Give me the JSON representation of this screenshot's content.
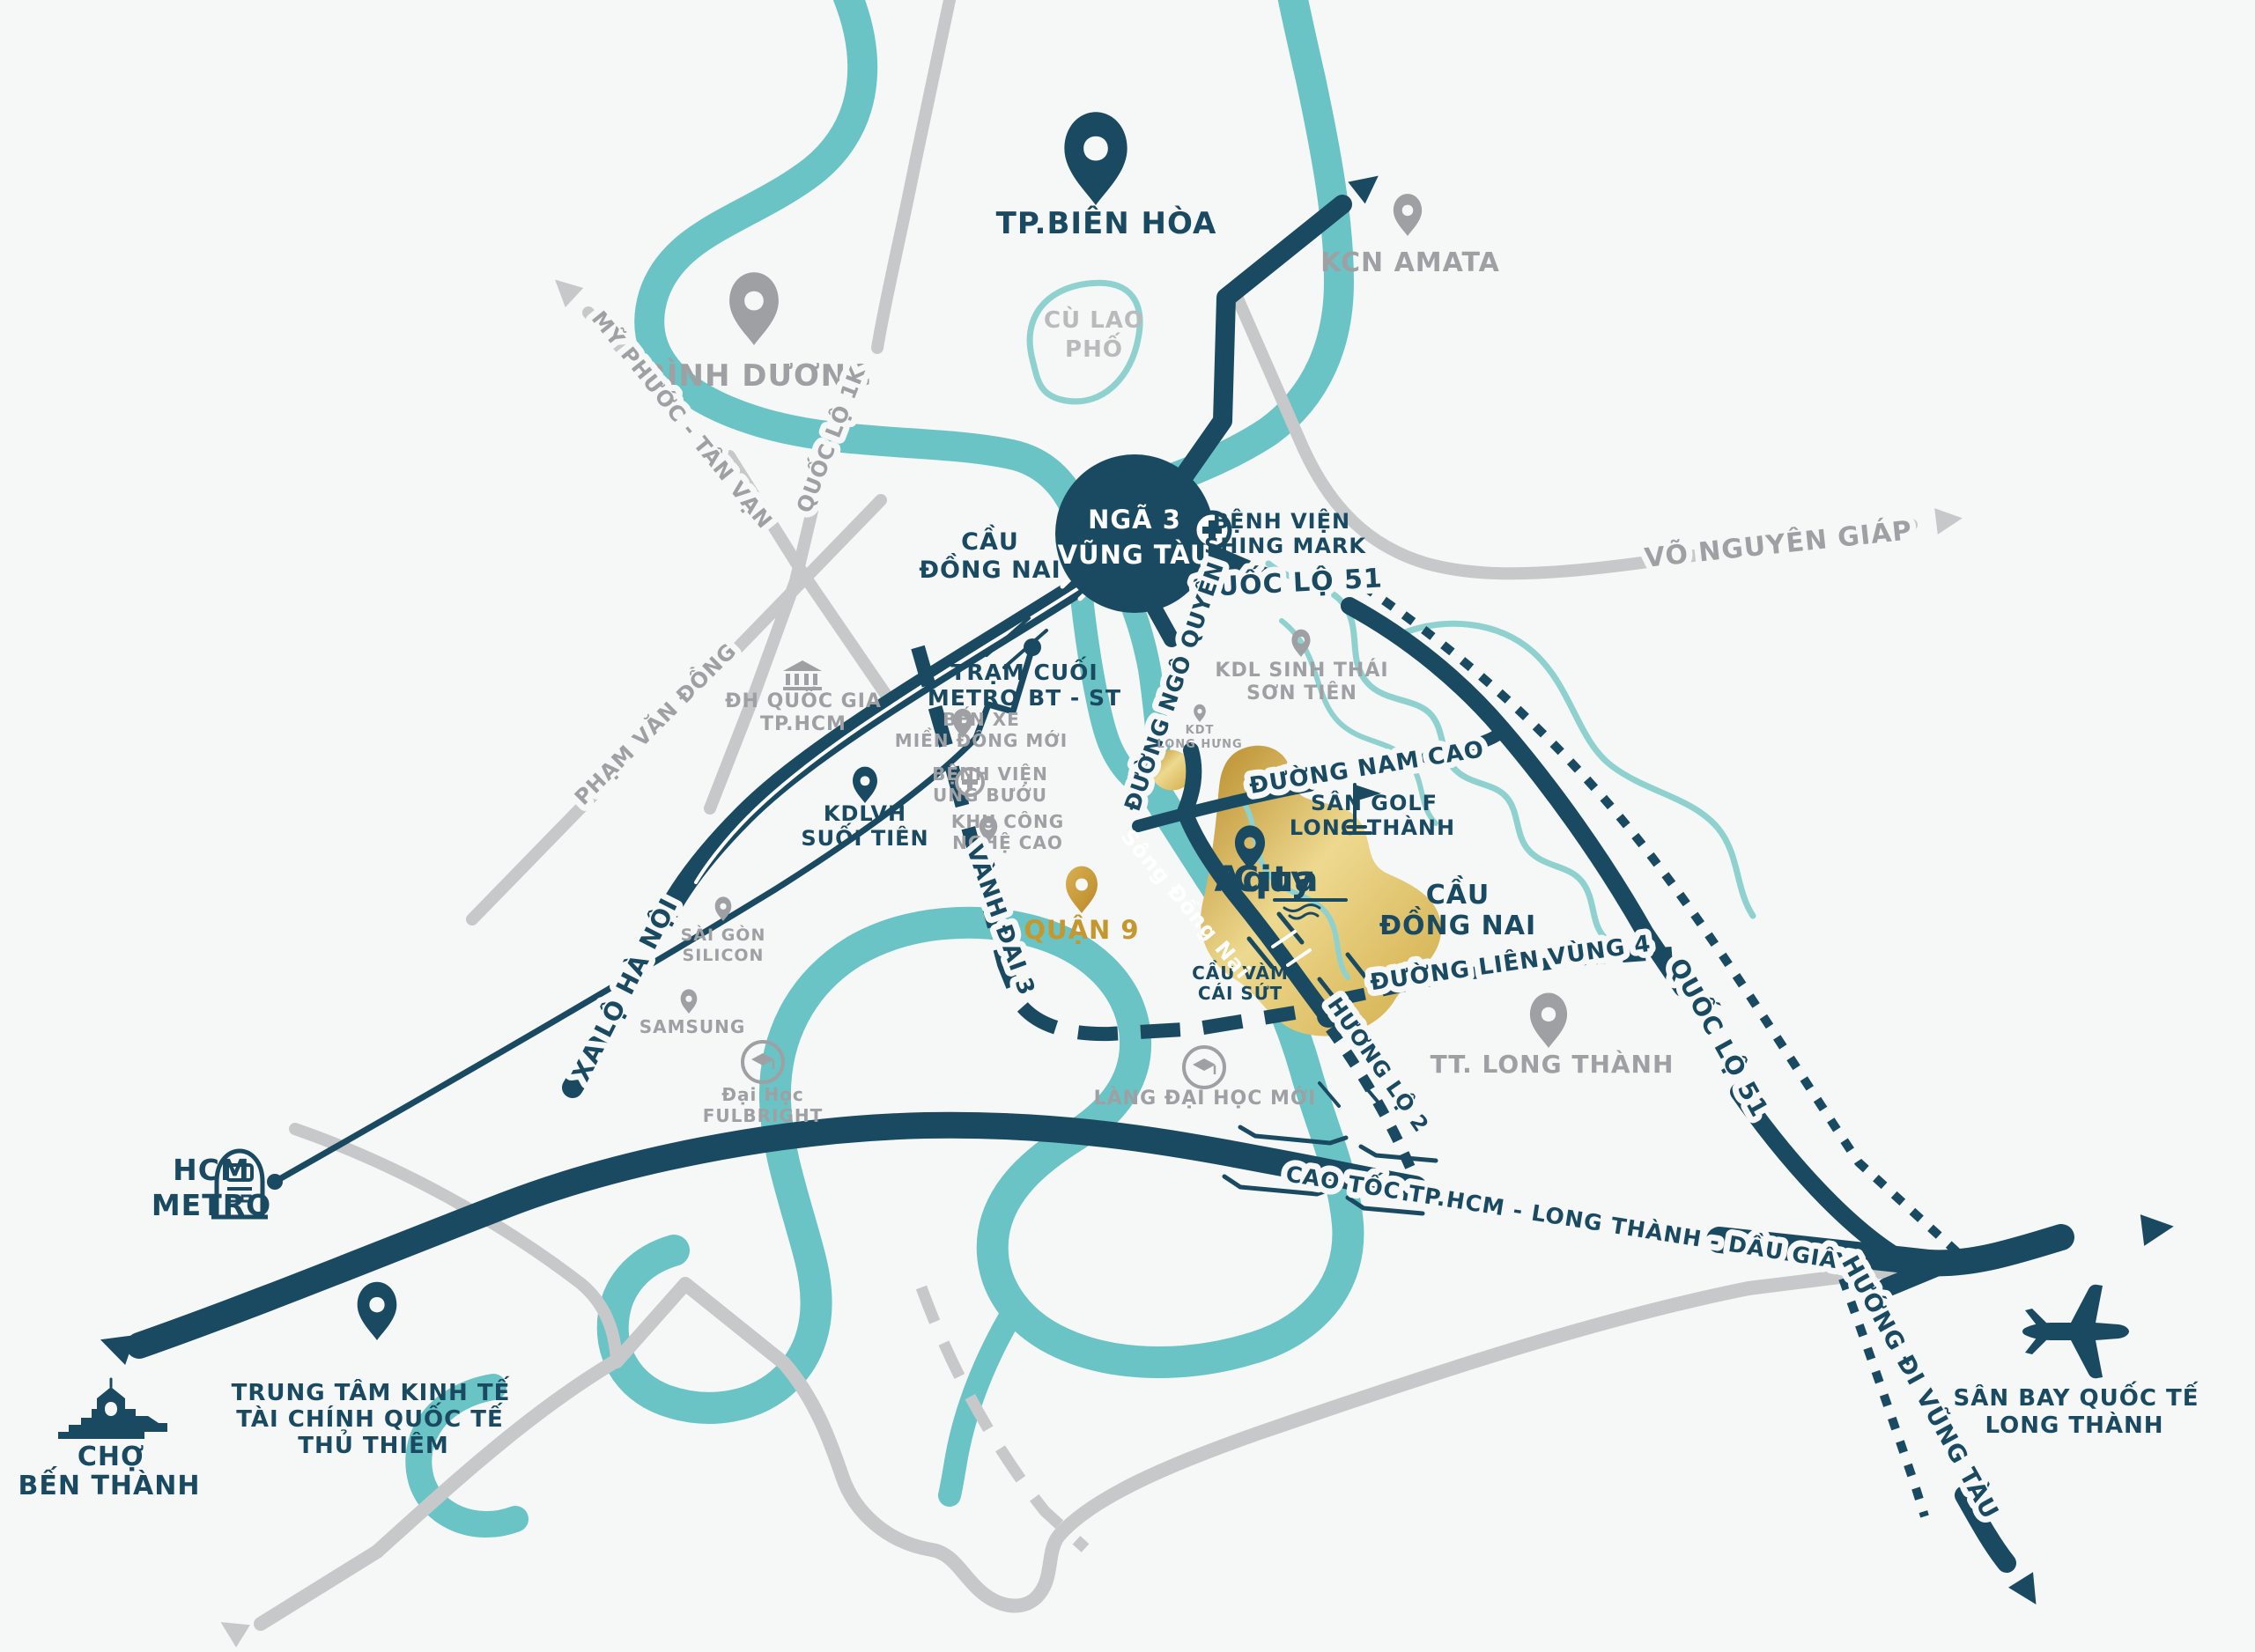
{
  "colors": {
    "navy": "#1A4A61",
    "teal": "#6AC4C5",
    "teal_light": "#8ED1CF",
    "gray_road": "#C7C8CA",
    "gray_text": "#9EA0A3",
    "gray_light_text": "#B8BABC",
    "gold_text": "#C4972F",
    "gold_dark": "#B98B2A",
    "gold_light": "#EDD98F",
    "white": "#FFFFFF",
    "bg": "#F6F7F7"
  },
  "icons": {
    "pin": "location-pin",
    "hospital": "hospital-cross",
    "university": "university-columns",
    "graduation": "graduation-cap",
    "golf": "golf-flag",
    "airplane": "airplane",
    "metro": "metro-train",
    "market": "ben-thanh-market",
    "arrow": "direction-arrow",
    "roundabout": "roundabout-circle"
  },
  "labels": {
    "tp_bien_hoa": "TP.BIÊN HÒA",
    "kcn_amata": "KCN AMATA",
    "binh_duong": "BÌNH DƯƠNG",
    "cu_lao_pho": {
      "l1": "CÙ LAO",
      "l2": "PHỐ"
    },
    "nga_3_vung_tau": {
      "l1": "NGÃ 3",
      "l2": "VŨNG TÀU"
    },
    "cau_dong_nai_w": {
      "l1": "CẦU",
      "l2": "ĐỒNG NAI"
    },
    "benh_vien_shing_mark": {
      "l1": "BỆNH VIỆN",
      "l2": "SHING MARK"
    },
    "quoc_lo_51_top": "QUỐC LỘ 51",
    "vo_nguyen_giap": "VÕ NGUYÊN GIÁP",
    "duong_ngo_quyen": "ĐƯỜNG NGÔ QUYỀN",
    "tram_cuoi_metro": {
      "l1": "TRẠM CUỐI",
      "l2": "METRO BT - ST"
    },
    "ben_xe": {
      "l1": "BẾN XE",
      "l2": "MIỀN ĐÔNG MỚI"
    },
    "benh_vien_ung_buou": {
      "l1": "BỆNH VIỆN",
      "l2": "UNG BƯỚU"
    },
    "khu_cong_nghe_cao": {
      "l1": "KHU CÔNG",
      "l2": "NGHỆ CAO"
    },
    "kdlvh_suoi_tien": {
      "l1": "KDLVH",
      "l2": "SUỐI TIÊN"
    },
    "kdl_son_tien": {
      "l1": "KDL SINH THÁI",
      "l2": "SƠN TIÊN"
    },
    "kdt_long_hung": {
      "l1": "KDT",
      "l2": "LONG HƯNG"
    },
    "quan_9": "QUẬN 9",
    "vanh_dai_3": "VÀNH ĐAI 3",
    "sai_gon_silicon": {
      "l1": "SÀI GÒN",
      "l2": "SILICON"
    },
    "samsung": "SAMSUNG",
    "dai_hoc_fulbright": {
      "l1": "Đại Học",
      "l2": "FULBRIGHT"
    },
    "xa_lo_ha_noi": "XA LỘ HÀ NỘI",
    "lang_dai_hoc_moi": "LÀNG ĐẠI HỌC MỚI",
    "cau_vam_cai_sut": {
      "l1": "CẦU VÀM",
      "l2": "CÁI SỨT"
    },
    "song_dong_nai": "Sông Đồng Nai",
    "duong_nam_cao": "ĐƯỜNG NAM CAO",
    "san_golf_long_thanh": {
      "l1": "SÂN GOLF",
      "l2": "LONG THÀNH"
    },
    "cau_dong_nai_e": {
      "l1": "CẦU",
      "l2": "ĐỒNG NAI"
    },
    "duong_lien_vung_4": "ĐƯỜNG LIÊN VÙNG 4",
    "tt_long_thanh": "TT. LONG THÀNH",
    "quoc_lo_51_se": "QUỐC LỘ 51",
    "huong_lo_2": "HƯƠNG LỘ 2",
    "cao_toc": "CAO TỐC TP.HCM - LONG THÀNH - DẦU GIÂY",
    "huong_di_vung_tau": "HƯỚNG ĐI VŨNG TÀU",
    "san_bay": {
      "l1": "SÂN BAY QUỐC TẾ",
      "l2": "LONG THÀNH"
    },
    "hcm_metro": {
      "l1": "HCM",
      "l2": "METRO"
    },
    "cho_ben_thanh": {
      "l1": "CHỢ",
      "l2": "BẾN THÀNH"
    },
    "thu_thiem": {
      "l1": "TRUNG TÂM KINH TẾ",
      "l2": "TÀI CHÍNH QUỐC TẾ",
      "l3": "THỦ THIÊM"
    },
    "my_phuoc_tan_van": "MỸ PHƯỚC - TÂN VẠN",
    "quoc_lo_1k": "QUỐC LỘ 1K",
    "pham_van_dong": "PHẠM VĂN ĐỒNG",
    "dh_quoc_gia": {
      "l1": "ĐH QUỐC GIA",
      "l2": "TP.HCM"
    },
    "aqua_city": {
      "l1": "Aqua",
      "l2": "City"
    }
  }
}
